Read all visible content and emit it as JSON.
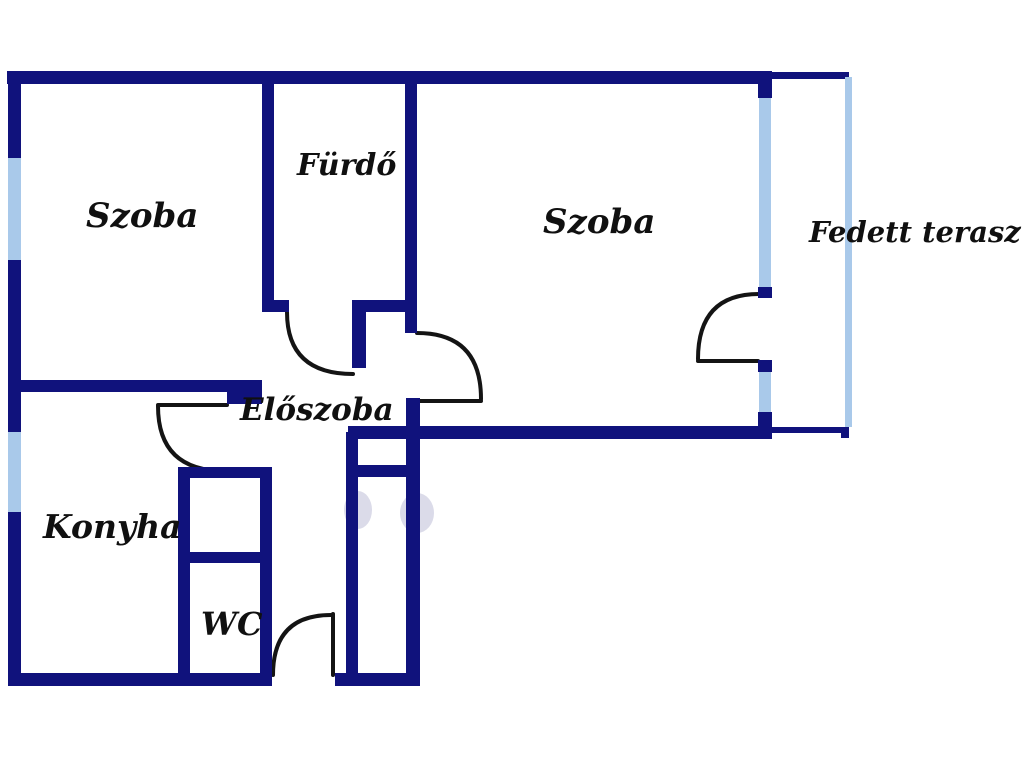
{
  "diagram": {
    "type": "floor-plan",
    "rooms": {
      "szoba_left": {
        "label": "Szoba"
      },
      "furdo": {
        "label": "Fürdő"
      },
      "szoba_right": {
        "label": "Szoba"
      },
      "fedett_terasz": {
        "label": "Fedett terasz"
      },
      "eloszoba": {
        "label": "Előszoba"
      },
      "konyha": {
        "label": "Konyha"
      },
      "wc": {
        "label": "WC"
      }
    },
    "legend": {
      "wall_meaning": "wall",
      "window_meaning": "window",
      "arc_meaning": "door swing"
    }
  },
  "colors": {
    "wall": "#10127c",
    "window": "#a9c9ea",
    "door": "#141414",
    "bg": "#ffffff",
    "text": "#101010"
  }
}
